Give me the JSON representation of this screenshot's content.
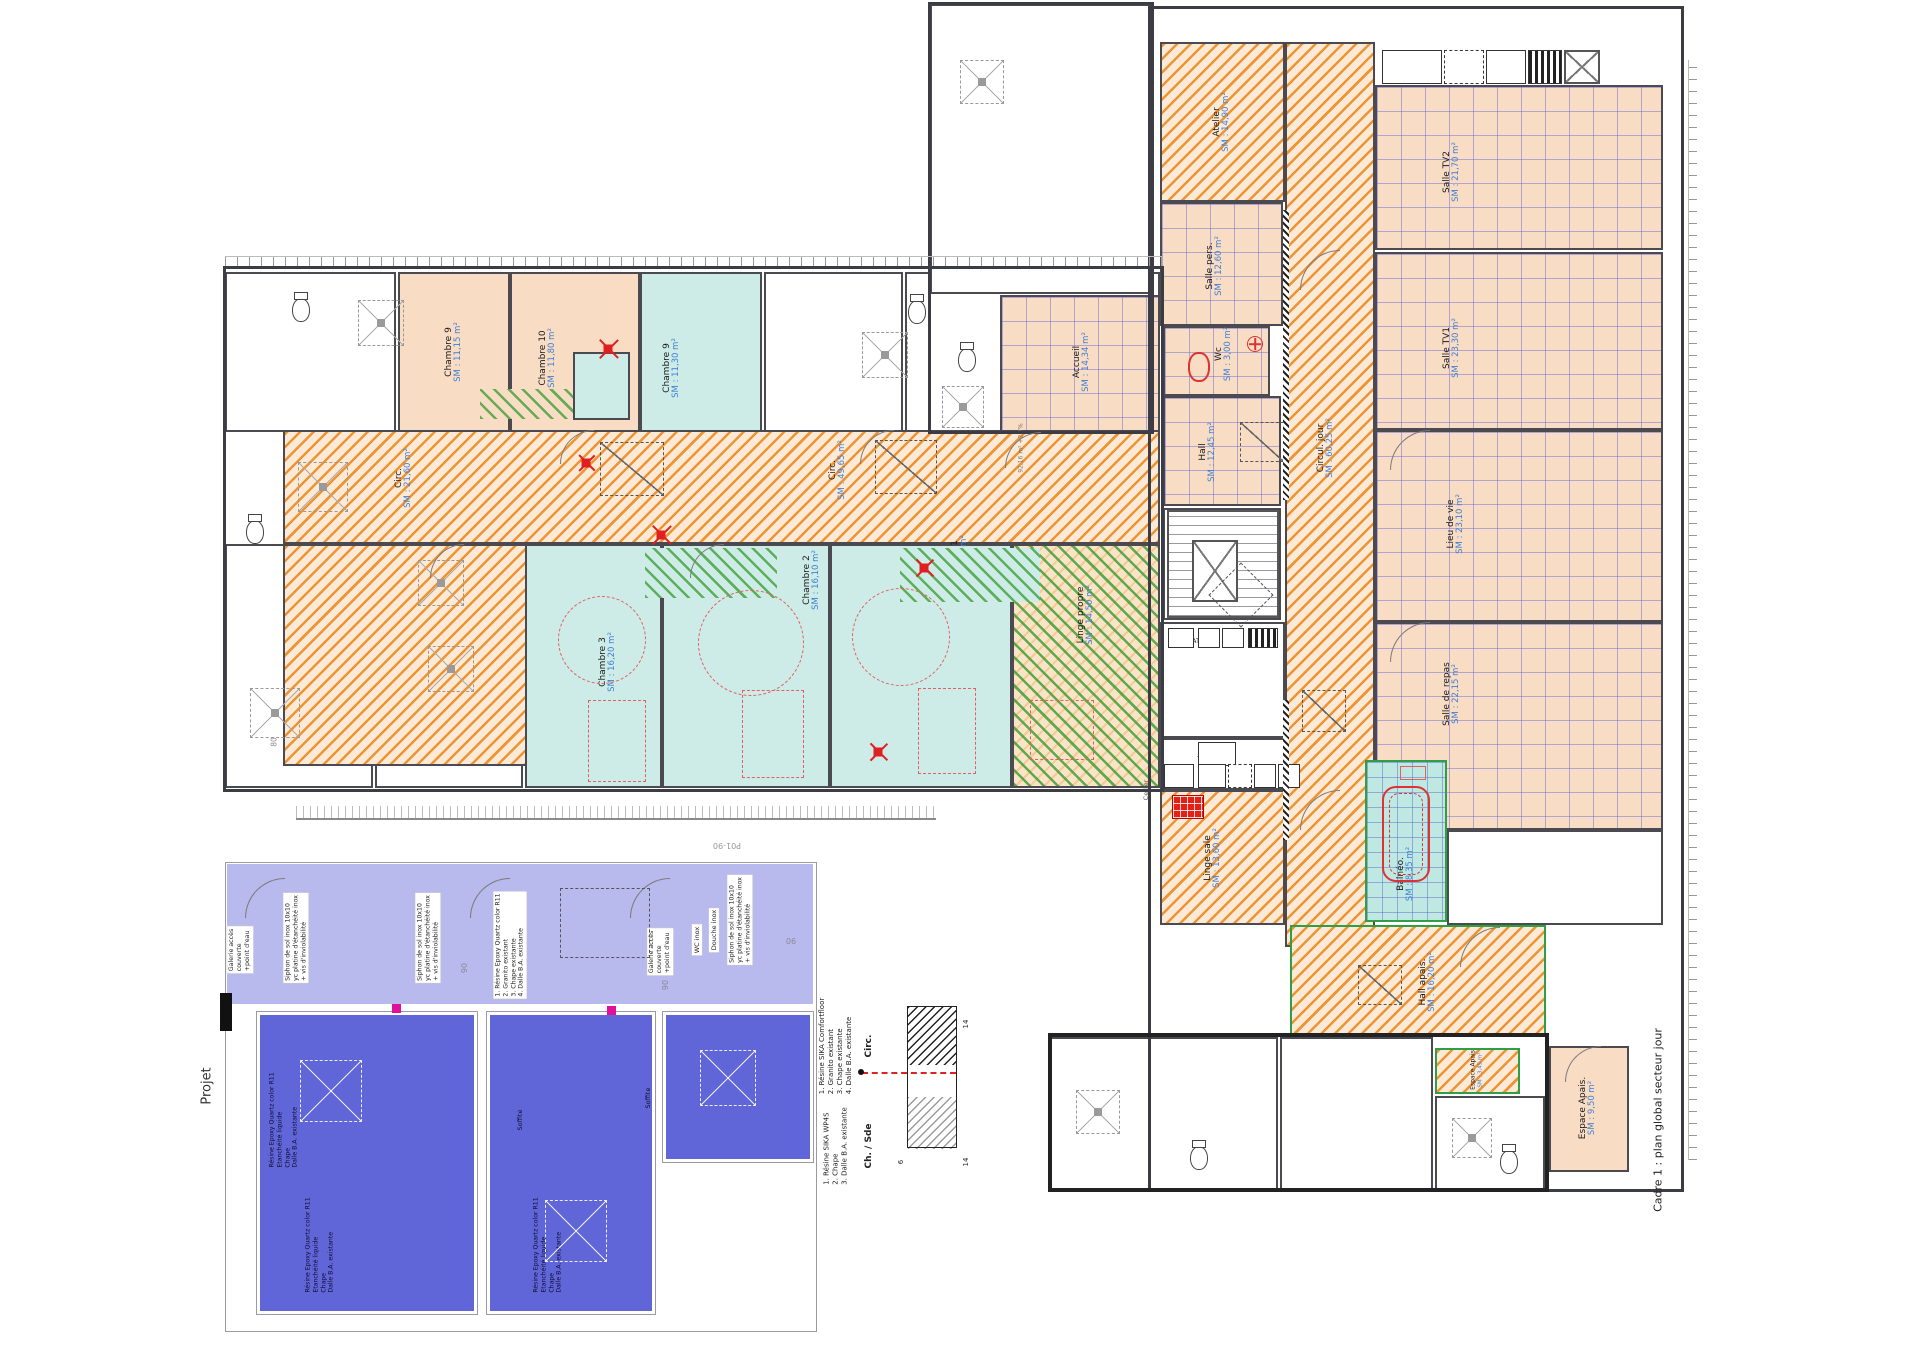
{
  "captions": {
    "frame_caption": "Cadre 1 : plan global secteur jour",
    "side_label": "Projet",
    "sheet_ref": "P01-90"
  },
  "legend": {
    "circ_title": "Circ.",
    "circ_lines": [
      "1. Résine SIKA Comfortfloor",
      "2. Granito existant",
      "3. Chape existante",
      "4. Dalle B.A. existante"
    ],
    "chsde_title": "Ch. / Sde",
    "chsde_lines": [
      "1. Résine SIKA WP4S",
      "2. Chape",
      "3. Dalle B.A. existante"
    ],
    "dims": [
      "14",
      "6",
      "14"
    ]
  },
  "rooms": [
    {
      "n": "",
      "a": "",
      "x": 225,
      "y": 272,
      "w": 171,
      "h": 160,
      "f": "white"
    },
    {
      "n": "",
      "a": "",
      "x": 764,
      "y": 272,
      "w": 139,
      "h": 160,
      "f": "white"
    },
    {
      "n": "",
      "a": "",
      "x": 905,
      "y": 272,
      "w": 255,
      "h": 160,
      "f": "white"
    },
    {
      "n": "",
      "a": "",
      "x": 225,
      "y": 544,
      "w": 148,
      "h": 244,
      "f": "white"
    },
    {
      "n": "",
      "a": "",
      "x": 375,
      "y": 544,
      "w": 148,
      "h": 244,
      "f": "white"
    },
    {
      "n": "",
      "a": "",
      "x": 930,
      "y": 4,
      "w": 222,
      "h": 290,
      "f": "white"
    },
    {
      "n": "",
      "a": "",
      "x": 1163,
      "y": 508,
      "w": 118,
      "h": 112,
      "f": "white"
    },
    {
      "n": "",
      "a": "",
      "x": 1160,
      "y": 622,
      "w": 125,
      "h": 116,
      "f": "white"
    },
    {
      "n": "",
      "a": "",
      "x": 1160,
      "y": 738,
      "w": 125,
      "h": 52,
      "f": "white"
    },
    {
      "n": "",
      "a": "",
      "x": 1050,
      "y": 1037,
      "w": 228,
      "h": 153,
      "f": "white"
    },
    {
      "n": "",
      "a": "",
      "x": 1280,
      "y": 1037,
      "w": 153,
      "h": 153,
      "f": "white"
    },
    {
      "n": "",
      "a": "",
      "x": 1435,
      "y": 1096,
      "w": 110,
      "h": 94,
      "f": "white"
    },
    {
      "n": "",
      "a": "",
      "x": 1447,
      "y": 830,
      "w": 216,
      "h": 95,
      "f": "white"
    },
    {
      "n": "Chambre 9",
      "a": "SM : 11,15 m²",
      "x": 398,
      "y": 272,
      "w": 112,
      "h": 160,
      "f": "peach"
    },
    {
      "n": "Chambre 10",
      "a": "SM : 11,80 m²",
      "x": 510,
      "y": 272,
      "w": 130,
      "h": 160,
      "f": "peach",
      "lx": 548,
      "ly": 358
    },
    {
      "n": "Chambre 9",
      "a": "SM : 11,30 m²",
      "x": 640,
      "y": 272,
      "w": 122,
      "h": 160,
      "f": "cyan",
      "lx": 672,
      "ly": 368
    },
    {
      "n": "Circ.",
      "a": "SM : 49,65 m²",
      "x": 283,
      "y": 430,
      "w": 877,
      "h": 114,
      "f": "orange",
      "lx": 838,
      "ly": 470
    },
    {
      "n": "Circ.",
      "a": "SM : 21,60 m²",
      "x": 283,
      "y": 544,
      "w": 262,
      "h": 222,
      "f": "orange",
      "lx": 404,
      "ly": 478
    },
    {
      "n": "Chambre 3",
      "a": "SM : 16,20 m²",
      "x": 525,
      "y": 544,
      "w": 137,
      "h": 244,
      "f": "cyan",
      "lx": 608,
      "ly": 662
    },
    {
      "n": "Chambre 2",
      "a": "SM : 16,10 m²",
      "x": 662,
      "y": 544,
      "w": 168,
      "h": 244,
      "f": "cyan",
      "lx": 812,
      "ly": 580
    },
    {
      "n": "Chambre 1",
      "a": "SM : 15,95 m²",
      "x": 830,
      "y": 544,
      "w": 182,
      "h": 244,
      "f": "cyan",
      "lx": 960,
      "ly": 565
    },
    {
      "n": "Linge propre",
      "a": "SM : 14,50 m²",
      "x": 1012,
      "y": 544,
      "w": 148,
      "h": 244,
      "f": "greenorange",
      "lx": 1086,
      "ly": 615
    },
    {
      "n": "Atelier",
      "a": "SM : 14,90 m²",
      "x": 1160,
      "y": 42,
      "w": 125,
      "h": 160,
      "f": "orange",
      "lx": 1222,
      "ly": 122
    },
    {
      "n": "Salle TV2",
      "a": "SM : 21,70 m²",
      "x": 1375,
      "y": 85,
      "w": 288,
      "h": 165,
      "f": "tile",
      "lx": 1452,
      "ly": 172
    },
    {
      "n": "Salle pers.",
      "a": "SM : 12,60 m²",
      "x": 1160,
      "y": 202,
      "w": 123,
      "h": 124,
      "f": "tile",
      "lx": 1215,
      "ly": 266
    },
    {
      "n": "Salle TV1",
      "a": "SM : 23,30 m²",
      "x": 1375,
      "y": 252,
      "w": 288,
      "h": 178,
      "f": "tile",
      "lx": 1452,
      "ly": 348
    },
    {
      "n": "Accueil",
      "a": "SM : 14,34 m²",
      "x": 1000,
      "y": 295,
      "w": 160,
      "h": 137,
      "f": "tile",
      "lx": 1082,
      "ly": 362
    },
    {
      "n": "Wc",
      "a": "SM : 3,00 m²",
      "x": 1163,
      "y": 326,
      "w": 107,
      "h": 70,
      "f": "tile",
      "lx": 1224,
      "ly": 354
    },
    {
      "n": "Hall",
      "a": "SM : 12,45 m²",
      "x": 1163,
      "y": 396,
      "w": 118,
      "h": 110,
      "f": "tile",
      "lx": 1208,
      "ly": 452
    },
    {
      "n": "Circul. jour",
      "a": "SM : 60,25 m²",
      "x": 1285,
      "y": 42,
      "w": 90,
      "h": 905,
      "f": "orange",
      "lx": 1326,
      "ly": 448
    },
    {
      "n": "Lieu de vie",
      "a": "SM : 23,10 m²",
      "x": 1375,
      "y": 430,
      "w": 288,
      "h": 192,
      "f": "tile",
      "lx": 1456,
      "ly": 524
    },
    {
      "n": "Salle de repas",
      "a": "SM : 22,15 m²",
      "x": 1375,
      "y": 622,
      "w": 288,
      "h": 208,
      "f": "tile",
      "lx": 1452,
      "ly": 694
    },
    {
      "n": "Linge sale",
      "a": "SM : 13,60 m²",
      "x": 1160,
      "y": 790,
      "w": 125,
      "h": 135,
      "f": "orange",
      "lx": 1213,
      "ly": 858
    },
    {
      "n": "Balnéo.",
      "a": "SM : 8,35 m²",
      "x": 1365,
      "y": 760,
      "w": 82,
      "h": 162,
      "f": "cyantile",
      "gb": 1,
      "lx": 1406,
      "ly": 874
    },
    {
      "n": "Hall apais.",
      "a": "SM : 16,20 m²",
      "x": 1290,
      "y": 925,
      "w": 256,
      "h": 112,
      "f": "orange",
      "gb": 1,
      "lx": 1428,
      "ly": 982
    },
    {
      "n": "Espace Apais",
      "a": "SM : 3,45 m²",
      "x": 1435,
      "y": 1048,
      "w": 85,
      "h": 46,
      "f": "orange",
      "gb": 1,
      "lx": 1477,
      "ly": 1070,
      "fs": 6
    },
    {
      "n": "Espace Apais.",
      "a": "SM : 9,50 m²",
      "x": 1549,
      "y": 1046,
      "w": 80,
      "h": 126,
      "f": "peach",
      "lx": 1588,
      "ly": 1108
    },
    {
      "n": "",
      "a": "",
      "x": 480,
      "y": 389,
      "w": 93,
      "h": 30,
      "f": "greenpeach",
      "nb": 1
    },
    {
      "n": "",
      "a": "",
      "x": 573,
      "y": 352,
      "w": 57,
      "h": 68,
      "f": "cyan"
    },
    {
      "n": "",
      "a": "",
      "x": 645,
      "y": 548,
      "w": 132,
      "h": 50,
      "f": "greencyan",
      "nb": 1
    },
    {
      "n": "",
      "a": "",
      "x": 900,
      "y": 548,
      "w": 140,
      "h": 54,
      "f": "greencyan",
      "nb": 1
    },
    {
      "n": "",
      "a": "",
      "x": 227,
      "y": 864,
      "w": 586,
      "h": 140,
      "f": "lav",
      "nb": 1
    },
    {
      "n": "",
      "a": "",
      "x": 257,
      "y": 1012,
      "w": 220,
      "h": 302,
      "f": "blue"
    },
    {
      "n": "",
      "a": "",
      "x": 487,
      "y": 1012,
      "w": 168,
      "h": 302,
      "f": "blue"
    },
    {
      "n": "",
      "a": "",
      "x": 663,
      "y": 1012,
      "w": 150,
      "h": 150,
      "f": "blue"
    }
  ],
  "annotations": [
    {
      "t": "Cellier",
      "x": 1146,
      "y": 790,
      "s": 6.5,
      "c": "#555"
    },
    {
      "t": "92,16 m² +2,7%",
      "x": 1021,
      "y": 448,
      "s": 6,
      "c": "#777"
    },
    {
      "t": "AT",
      "x": 1196,
      "y": 641,
      "r": 0,
      "s": 6.5,
      "c": "#222"
    },
    {
      "t": "Chariot tiroir",
      "x": 1216,
      "y": 754,
      "r": 180,
      "s": 6,
      "c": "#222"
    },
    {
      "t": "Four",
      "x": 1179,
      "y": 777,
      "r": 180,
      "s": 6,
      "c": "#222"
    },
    {
      "t": "Plan",
      "x": 1211,
      "y": 777,
      "r": 180,
      "s": 6,
      "c": "#222"
    },
    {
      "t": "P",
      "x": 1264,
      "y": 776,
      "r": 180,
      "s": 6,
      "c": "#222"
    },
    {
      "t": "P",
      "x": 1288,
      "y": 776,
      "r": 180,
      "s": 6,
      "c": "#222"
    },
    {
      "t": "80",
      "x": 274,
      "y": 742,
      "s": 7.5,
      "c": "#8a8a95"
    },
    {
      "t": "90",
      "x": 465,
      "y": 968,
      "s": 8,
      "c": "#8a8a95"
    },
    {
      "t": "90",
      "x": 666,
      "y": 985,
      "s": 8,
      "c": "#8a8a95"
    },
    {
      "t": "90",
      "x": 791,
      "y": 940,
      "r": 180,
      "s": 8,
      "c": "#8a8a95"
    },
    {
      "t": "P01-90",
      "x": 727,
      "y": 845,
      "r": 180,
      "s": 8,
      "c": "#999"
    },
    {
      "t": "Galerie accès\ncouverte\n+point d'eau",
      "x": 240,
      "y": 950,
      "s": 6.3,
      "bg": 1
    },
    {
      "t": "Siphon de sol inox 10x10\nyc platine d'étanchéité inox\n+ vis d'inviolabilité",
      "x": 296,
      "y": 938,
      "s": 6.2,
      "bg": 1
    },
    {
      "t": "Siphon de sol inox 10x10\nyc platine d'étanchéité inox\n+ vis d'inviolabilité",
      "x": 428,
      "y": 938,
      "s": 6.2,
      "bg": 1
    },
    {
      "t": "1. Résine Epoxy Quartz color R11\n2. Granito existant\n3. Chape existante\n4. Dalle B.A. existante",
      "x": 510,
      "y": 945,
      "s": 6.2,
      "bg": 1
    },
    {
      "t": "Galerie accès\ncouverte\n+point d'eau",
      "x": 660,
      "y": 952,
      "s": 6.3,
      "bg": 1
    },
    {
      "t": "WC inox",
      "x": 697,
      "y": 940,
      "s": 6.5,
      "bg": 1
    },
    {
      "t": "Douche inox",
      "x": 714,
      "y": 930,
      "s": 6.5,
      "bg": 1
    },
    {
      "t": "Siphon de sol inox 10x10\nyc platine d'étanchéité inox\n+ vis d'inviolabilité",
      "x": 740,
      "y": 920,
      "s": 6.2,
      "bg": 1
    },
    {
      "t": "Résine Epoxy Quartz color R11\nEtanchéité liquide\nChape\nDalle B.A. existante",
      "x": 284,
      "y": 1120,
      "s": 6.2,
      "c": "#0d0d30"
    },
    {
      "t": "Résine Epoxy Quartz color R11\nEtanchéité liquide\nChape\nDalle B.A. existante",
      "x": 320,
      "y": 1245,
      "s": 6.2,
      "c": "#0d0d30"
    },
    {
      "t": "Résine Epoxy Quartz color R11\nEtanchéité liquide\nChape\nDalle B.A. existante",
      "x": 548,
      "y": 1245,
      "s": 6.2,
      "c": "#0d0d30"
    },
    {
      "t": "Soffite",
      "x": 520,
      "y": 1120,
      "s": 6.5,
      "c": "#0d0d30"
    },
    {
      "t": "Soffite",
      "x": 648,
      "y": 1098,
      "s": 6.5,
      "c": "#0d0d30"
    }
  ]
}
